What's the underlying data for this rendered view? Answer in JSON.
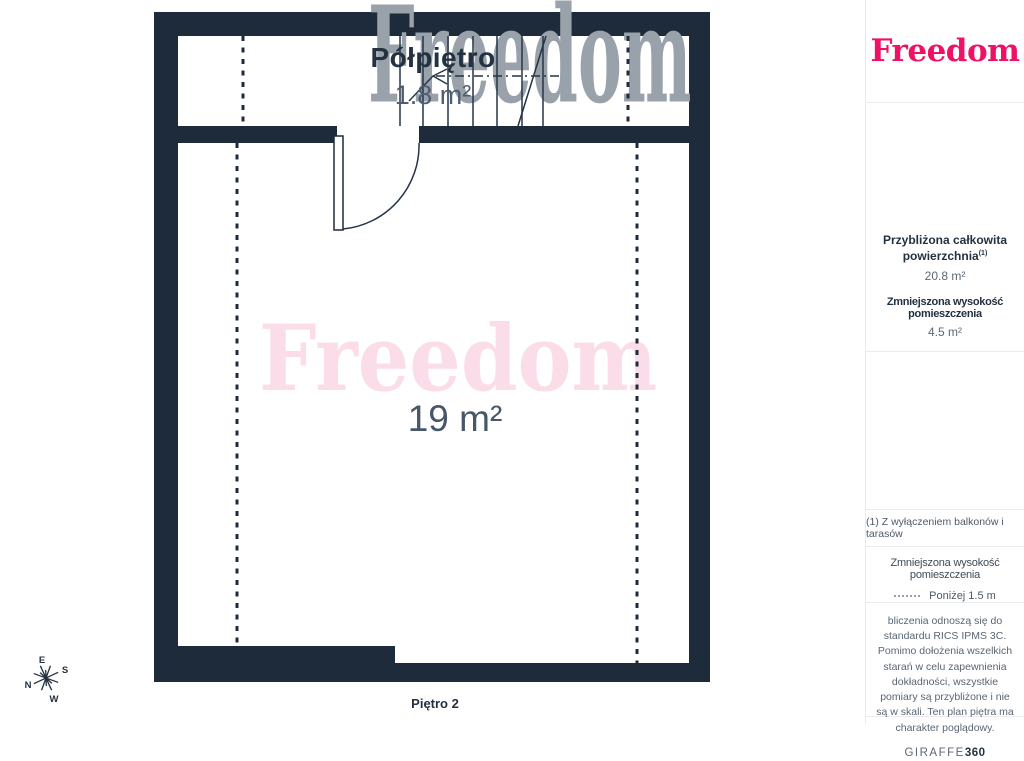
{
  "plan": {
    "mezzanine": {
      "name": "Półpiętro",
      "area": "1.8 m²"
    },
    "room": {
      "area": "19 m²"
    },
    "floor_caption": "Piętro 2",
    "compass": {
      "n": "N",
      "e": "E",
      "s": "S",
      "w": "W"
    }
  },
  "watermarks": {
    "top": "Freedom",
    "center": "Freedom"
  },
  "sidebar": {
    "logo": "Freedom",
    "stats": {
      "area_label_line1": "Przybliżona całkowita",
      "area_label_line2": "powierzchnia",
      "area_footnote_marker": "(1)",
      "area_value": "20.8 m²",
      "height_label": "Zmniejszona wysokość pomieszczenia",
      "height_value": "4.5 m²"
    },
    "footnote": "(1) Z wyłączeniem balkonów i tarasów",
    "legend": {
      "title": "Zmniejszona wysokość pomieszczenia",
      "item_label": "Poniżej 1.5 m"
    },
    "disclaimer": "bliczenia odnoszą się do standardu RICS IPMS 3C. Pomimo dołożenia wszelkich starań w celu zapewnienia dokładności, wszystkie pomiary są przybliżone i nie są w skali. Ten plan piętra ma charakter poglądowy.",
    "brand": {
      "giraffe": "GIRAFFE",
      "num360": "360"
    }
  },
  "colors": {
    "wall": "#1d2b3a",
    "accent_pink": "#ee1166",
    "watermark_pink": "#fbdce9",
    "watermark_gray": "#99a1aa",
    "label_dark": "#233140",
    "label_gray": "#4e5d70"
  }
}
